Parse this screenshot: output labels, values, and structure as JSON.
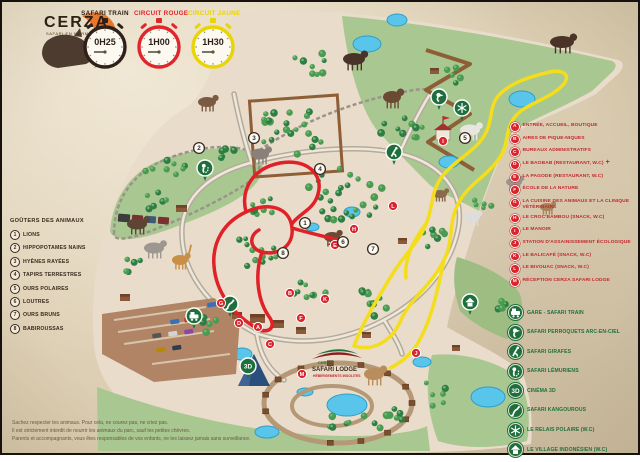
{
  "header": {
    "logo": {
      "title": "CERZA",
      "subtitle": "SAFARI EN NORMANDIE"
    },
    "circuits": [
      {
        "name": "SAFARI TRAIN",
        "duration": "0H25",
        "color": "#2f2119"
      },
      {
        "name": "CIRCUIT ROUGE",
        "duration": "1H00",
        "color": "#e2242b"
      },
      {
        "name": "CIRCUIT JAUNE",
        "duration": "1H30",
        "color": "#e9d404"
      }
    ]
  },
  "feeding_legend": {
    "title": "GOÛTERS DES ANIMAUX",
    "items": [
      {
        "num": "1",
        "label": "LIONS"
      },
      {
        "num": "2",
        "label": "HIPPOPOTAMES NAINS"
      },
      {
        "num": "3",
        "label": "HYÈNES RAYÉES"
      },
      {
        "num": "4",
        "label": "TAPIRS TERRESTRES"
      },
      {
        "num": "5",
        "label": "OURS POLAIRES"
      },
      {
        "num": "6",
        "label": "LOUTRES"
      },
      {
        "num": "7",
        "label": "OURS BRUNS"
      },
      {
        "num": "8",
        "label": "BABIROUSSAS"
      }
    ]
  },
  "facilities_legend": {
    "items": [
      {
        "letter": "A",
        "label": "ENTRÉE, ACCUEIL, BOUTIQUE"
      },
      {
        "letter": "B",
        "label": "AIRES DE PIQUE-NIQUES"
      },
      {
        "letter": "C",
        "label": "BUREAUX ADMINISTRATIFS"
      },
      {
        "letter": "D",
        "label": "LE BAOBAB (RESTAURANT, W.C)",
        "first_aid": "+"
      },
      {
        "letter": "E",
        "label": "LA PAGODE (RESTAURANT, W.C)"
      },
      {
        "letter": "F",
        "label": "ÉCOLE DE LA NATURE"
      },
      {
        "letter": "G",
        "label": "LA CUISINE DES ANIMAUX ET LA CLINIQUE VÉTÉRINAIRE"
      },
      {
        "letter": "H",
        "label": "LE CROC'BAMBOU (SNACK, W.C)"
      },
      {
        "letter": "I",
        "label": "LE MANOIR"
      },
      {
        "letter": "J",
        "label": "STATION D'ASSAINISSEMENT ÉCOLOGIQUE"
      },
      {
        "letter": "K",
        "label": "LE BALICAFÉ (SNACK, W.C)"
      },
      {
        "letter": "L",
        "label": "LE BIVOUAC (SNACK, W.C)"
      },
      {
        "letter": "M",
        "label": "RÉCEPTION CERZA SAFARI LODGE"
      }
    ]
  },
  "safari_legend": {
    "items": [
      {
        "icon": "train-icon",
        "label": "GARE - SAFARI TRAIN"
      },
      {
        "icon": "parrot-icon",
        "label": "SAFARI PERROQUETS ARC-EN-CIEL"
      },
      {
        "icon": "giraffe-icon",
        "label": "SAFARI GIRAFES"
      },
      {
        "icon": "lemur-icon",
        "label": "SAFARI LÉMURIENS"
      },
      {
        "icon": "cinema-3d-icon",
        "label": "CINÉMA 3D"
      },
      {
        "icon": "kangaroo-icon",
        "label": "SAFARI KANGOUROUS"
      },
      {
        "icon": "snowflake-icon",
        "label": "LE RELAIS POLAIRE (W.C)"
      },
      {
        "icon": "hut-icon",
        "label": "LE VILLAGE INDONÉSIEN (W.C)"
      }
    ]
  },
  "lodge": {
    "brand": "CERZA",
    "name": "SAFARI LODGE",
    "tagline": "HÉBERGEMENTS INSOLITES"
  },
  "footer": {
    "lines": [
      "Sachez respecter les animaux. Pour cela, ne courez pas, ne criez pas.",
      "Il est strictement interdit de nourrir les animaux du parc, sauf les petites chèvres.",
      "Parents et accompagnants, vous êtes responsables de vos enfants, ne les laissez jamais sans surveillance."
    ]
  },
  "map": {
    "feeding_markers": [
      {
        "num": "1",
        "x": 303,
        "y": 221
      },
      {
        "num": "2",
        "x": 197,
        "y": 146
      },
      {
        "num": "3",
        "x": 252,
        "y": 136
      },
      {
        "num": "4",
        "x": 318,
        "y": 167
      },
      {
        "num": "5",
        "x": 463,
        "y": 136
      },
      {
        "num": "6",
        "x": 341,
        "y": 240
      },
      {
        "num": "7",
        "x": 371,
        "y": 247
      },
      {
        "num": "8",
        "x": 281,
        "y": 251
      }
    ],
    "facility_markers": [
      {
        "letter": "A",
        "x": 256,
        "y": 325
      },
      {
        "letter": "B",
        "x": 288,
        "y": 291
      },
      {
        "letter": "C",
        "x": 268,
        "y": 342
      },
      {
        "letter": "D",
        "x": 237,
        "y": 321
      },
      {
        "letter": "E",
        "x": 333,
        "y": 243
      },
      {
        "letter": "F",
        "x": 299,
        "y": 316
      },
      {
        "letter": "G",
        "x": 219,
        "y": 301
      },
      {
        "letter": "H",
        "x": 352,
        "y": 227
      },
      {
        "letter": "I",
        "x": 441,
        "y": 139
      },
      {
        "letter": "J",
        "x": 414,
        "y": 351
      },
      {
        "letter": "K",
        "x": 323,
        "y": 297
      },
      {
        "letter": "L",
        "x": 391,
        "y": 204
      },
      {
        "letter": "M",
        "x": 300,
        "y": 372
      }
    ],
    "safari_markers": [
      {
        "icon": "train-icon",
        "x": 192,
        "y": 314
      },
      {
        "icon": "parrot-icon",
        "x": 437,
        "y": 95
      },
      {
        "icon": "giraffe-icon",
        "x": 392,
        "y": 150
      },
      {
        "icon": "lemur-icon",
        "x": 203,
        "y": 166
      },
      {
        "icon": "cinema-3d-icon",
        "x": 246,
        "y": 364
      },
      {
        "icon": "kangaroo-icon",
        "x": 228,
        "y": 302
      },
      {
        "icon": "snowflake-icon",
        "x": 460,
        "y": 106
      },
      {
        "icon": "hut-icon",
        "x": 468,
        "y": 300
      }
    ]
  },
  "colors": {
    "route_red": "#e02127",
    "route_yellow": "#f4dd1b",
    "marker_red": "#d9252b",
    "marker_green": "#1f6f3d",
    "legend_red_text": "#c4272e",
    "legend_green_text": "#1f6f3d",
    "pond_blue": "#5ac5ea",
    "parchment": "#ddcfb4",
    "map_ground": "#e9dcca",
    "meadow_green": "#a9c791"
  }
}
